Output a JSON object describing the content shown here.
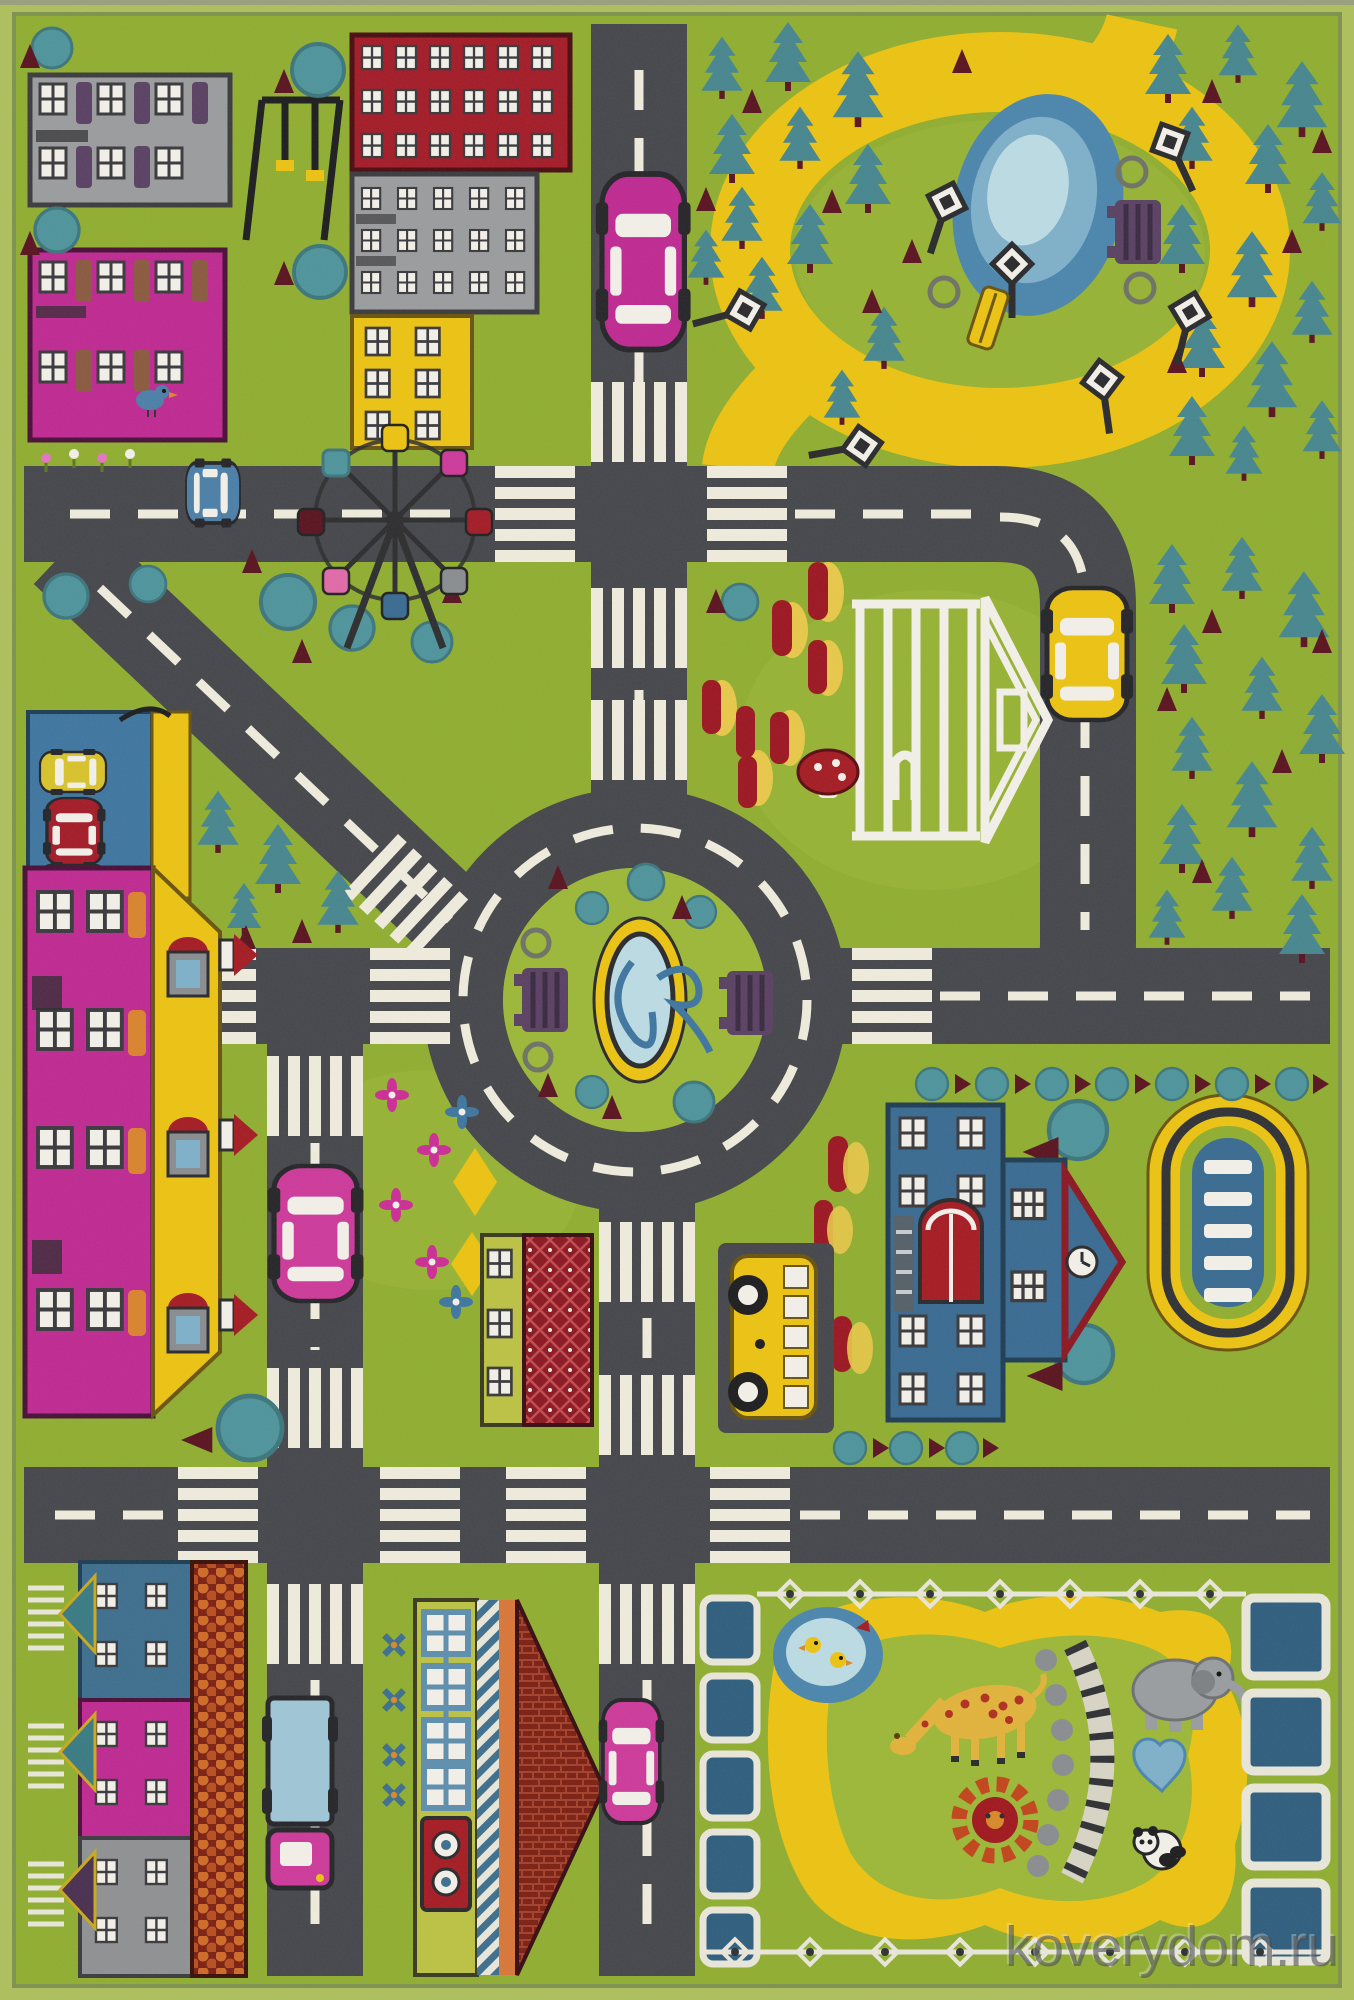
{
  "meta": {
    "description": "Photograph of a children's city-roads play rug sold by an online carpet shop",
    "watermark": "koverydom.ru"
  },
  "palette": {
    "border_light": "#aebf5d",
    "border_line": "#7e924f",
    "grass": "#90ae31",
    "grass_light": "#9cb838",
    "road": "#46474c",
    "road_line": "#efecdd",
    "yellow": "#ecc313",
    "pond_dark": "#4c86ad",
    "pond_mid": "#7fb0ca",
    "pond_light": "#bcdbe4",
    "magenta": "#bf2a92",
    "pink_car": "#cd3a9a",
    "red": "#a31c28",
    "dark_red": "#5a1420",
    "brick": "#7c2014",
    "gray_building": "#9b9c9e",
    "purple": "#5a4163",
    "teal": "#4f949c",
    "pine": "#47868f",
    "blue": "#3a6b92",
    "truck_blue": "#9fc6d6",
    "orange": "#c7571d",
    "white": "#f2f0e8",
    "black": "#2b2b2e"
  },
  "scene": {
    "landmarks": [
      "apartment-blocks",
      "playground-swing",
      "city-park-with-pond",
      "street-lamps",
      "ferris-wheel",
      "roundabout-with-fountain",
      "gazebo-pavilion",
      "tulip-beds",
      "parking-garage",
      "magenta-house-yellow-roof",
      "school-building",
      "swimming-pool",
      "terraced-houses",
      "brick-roof-house",
      "school-bus",
      "cars",
      "zoo-with-animals"
    ],
    "animals": [
      "giraffe",
      "elephant",
      "panda",
      "ducks"
    ]
  }
}
